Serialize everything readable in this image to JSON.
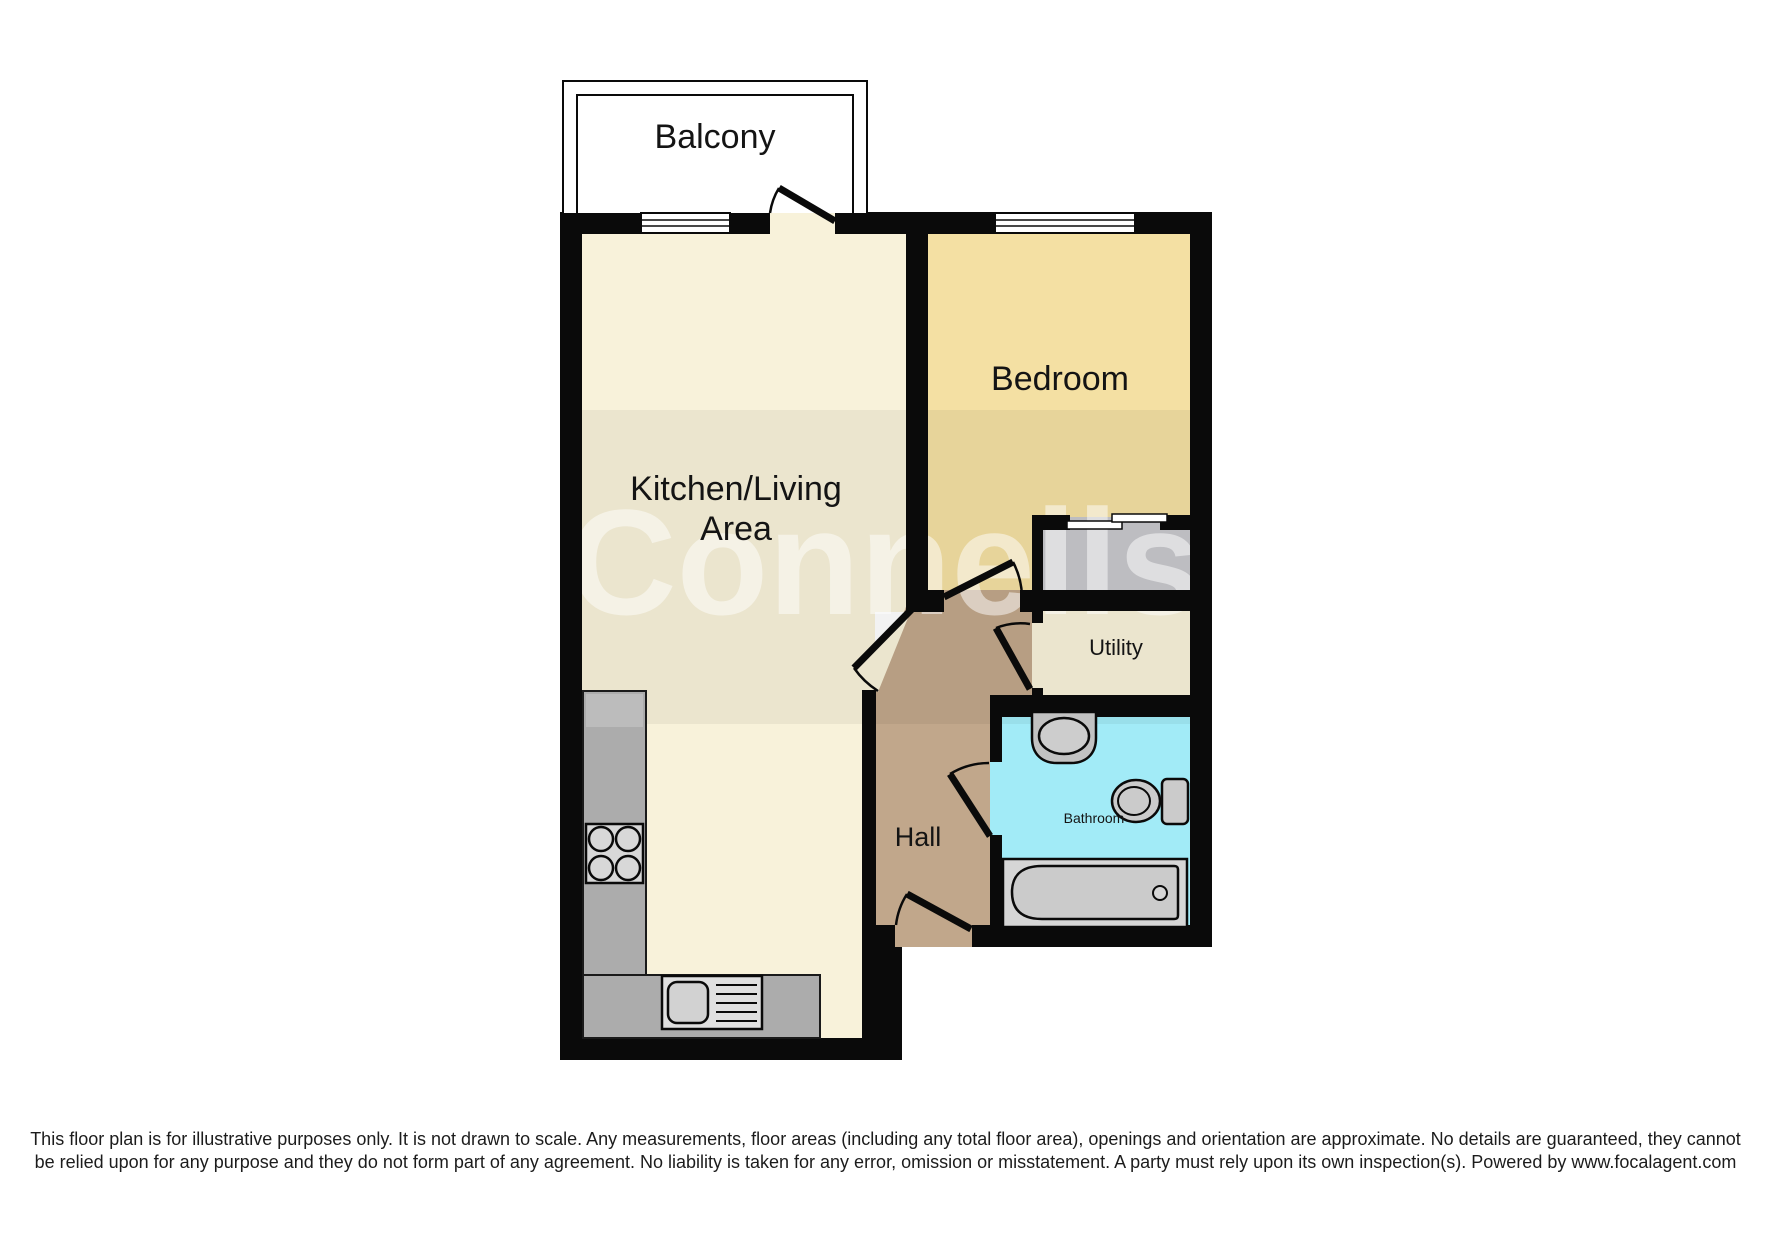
{
  "floor_plan": {
    "rooms": {
      "balcony": "Balcony",
      "kitchen_living_line1": "Kitchen/Living",
      "kitchen_living_line2": "Area",
      "bedroom": "Bedroom",
      "utility": "Utility",
      "hall": "Hall",
      "bathroom": "Bathroom"
    },
    "watermark": "Connells",
    "colors": {
      "wall": "#0a0a0a",
      "kitchen_living": "#F8F2DA",
      "bedroom": "#F4E0A3",
      "hall": "#C1A78B",
      "bathroom": "#A2EBF7",
      "utility": "#F8F2DA",
      "store": "#C8C8CC",
      "counter": "#ACACAC",
      "fixture": "#CBCBCB"
    }
  },
  "disclaimer": "This floor plan is for illustrative purposes only. It is not drawn to scale. Any measurements, floor areas (including any total floor area), openings and orientation are approximate. No details are guaranteed, they cannot be relied upon for any purpose and they do not form part of any agreement. No liability is taken for any error, omission or misstatement. A party must rely upon its own inspection(s). Powered by www.focalagent.com"
}
